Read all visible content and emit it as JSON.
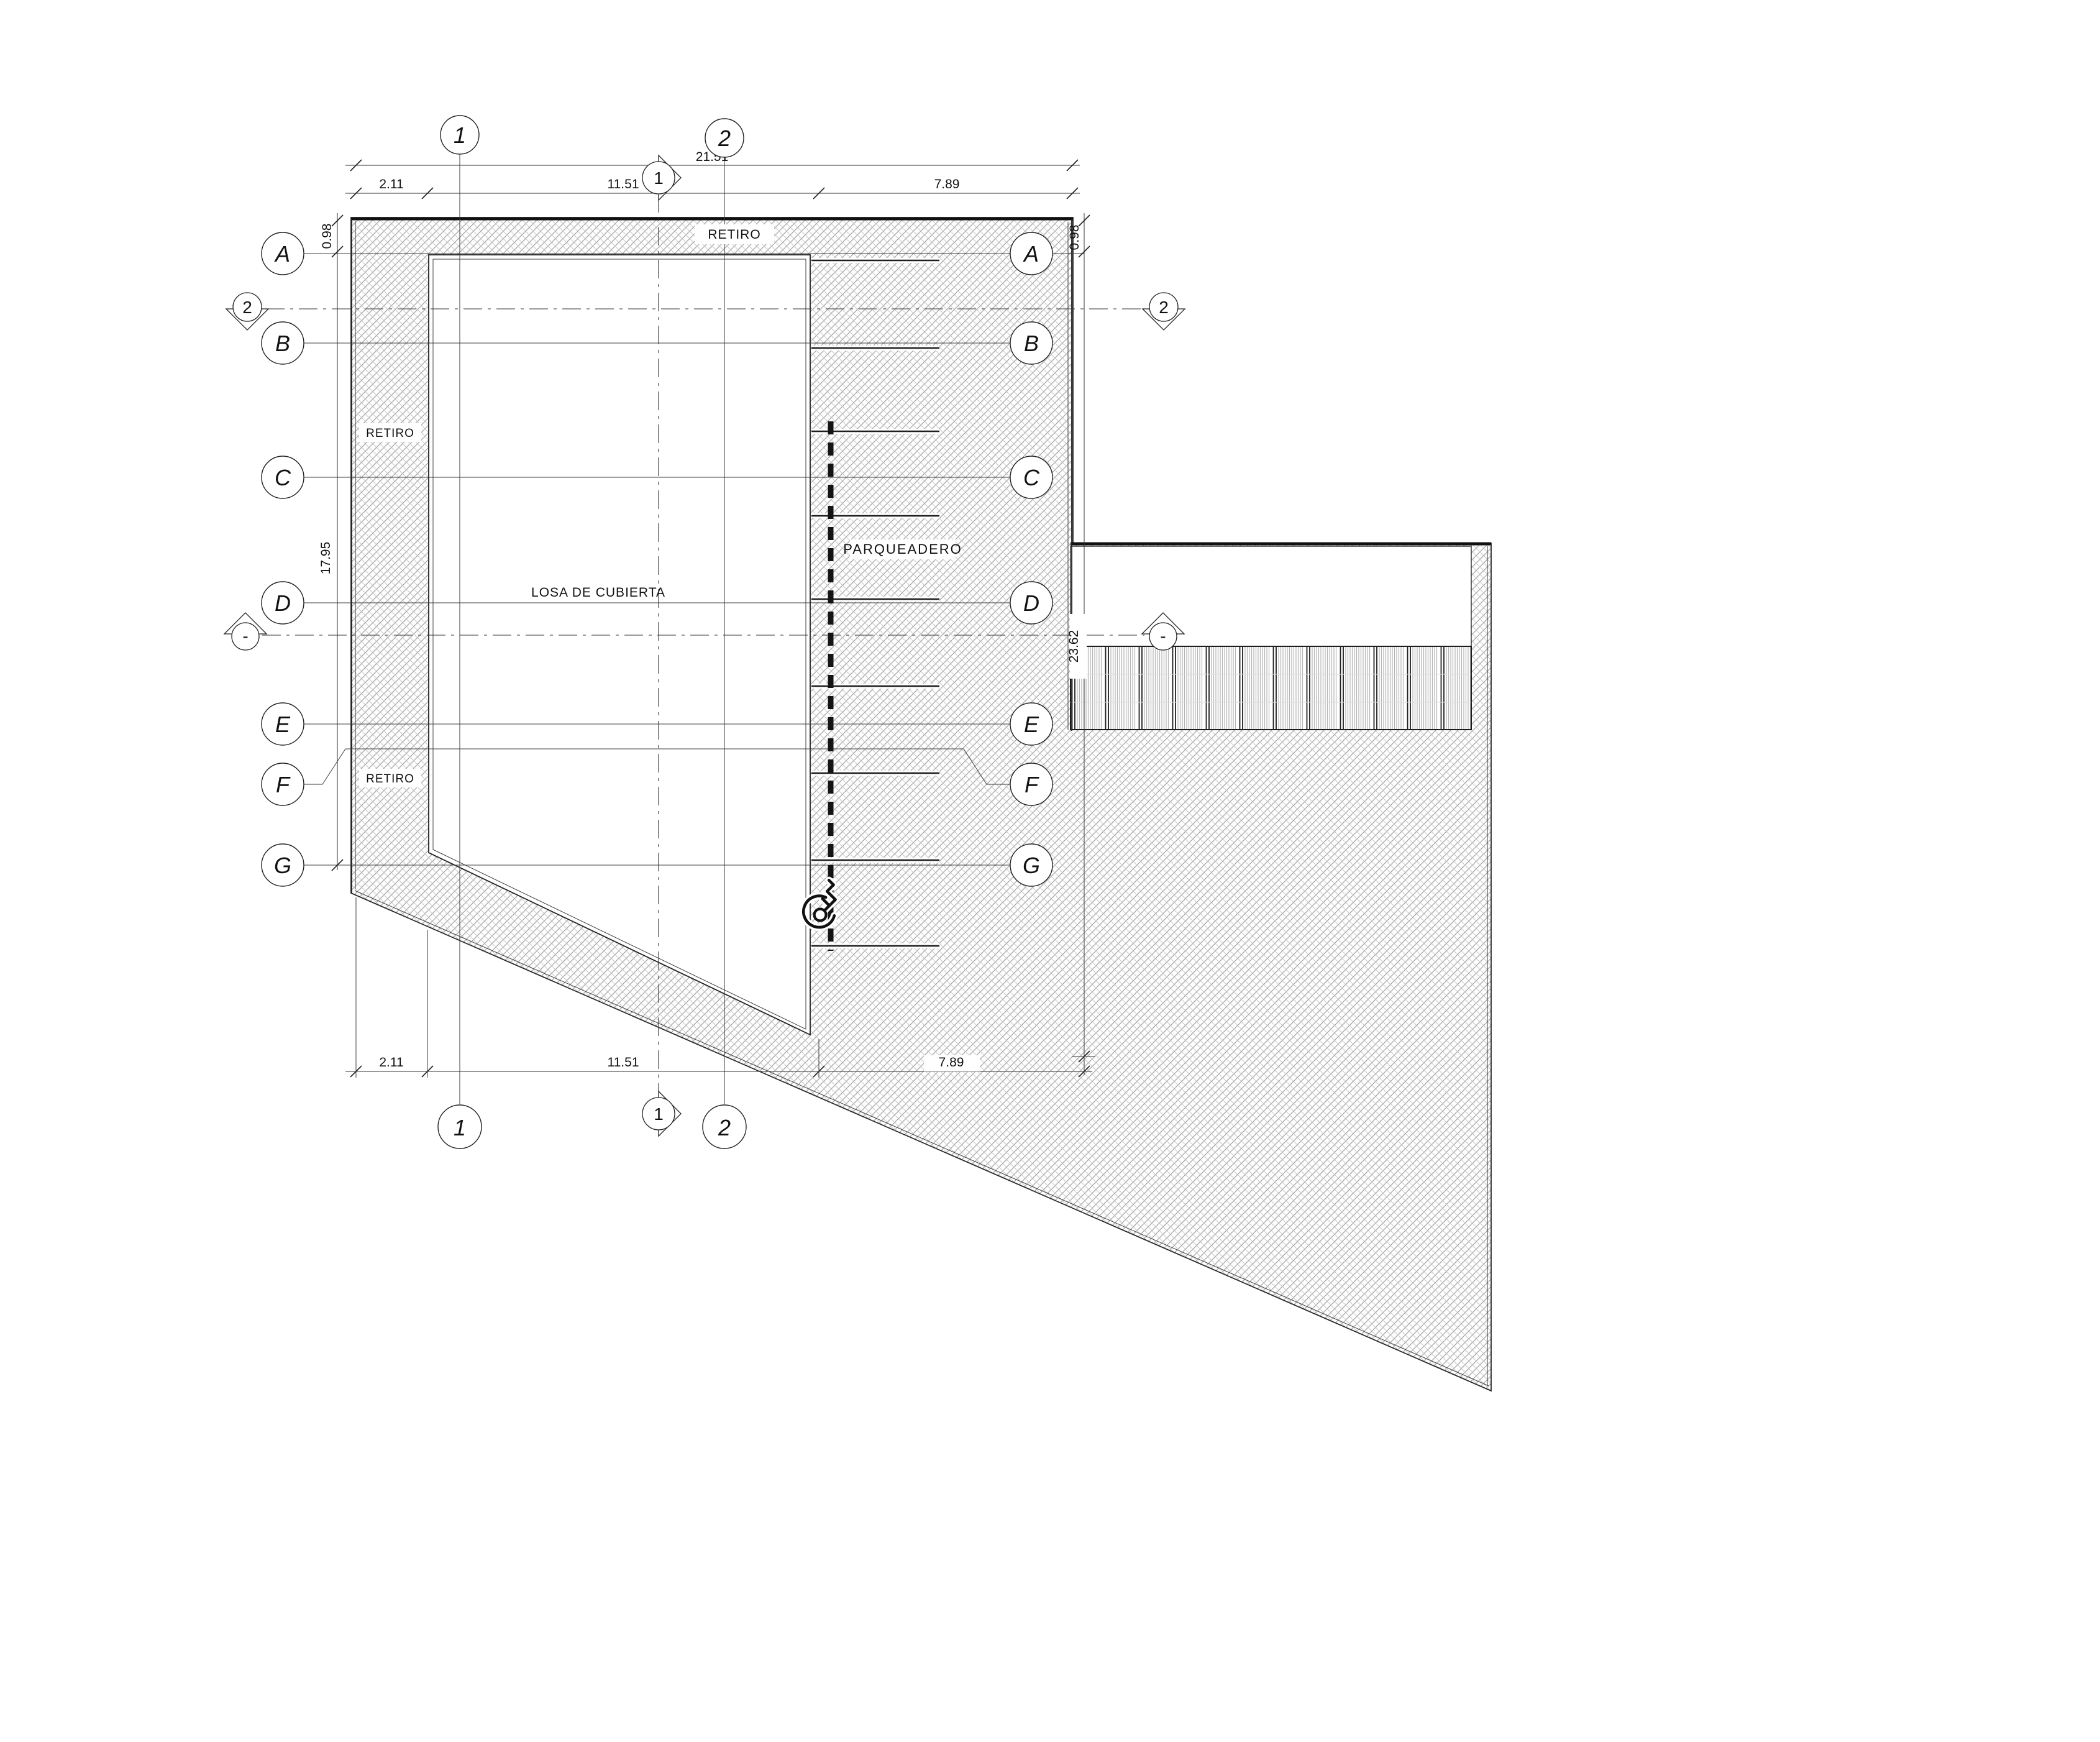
{
  "plan": {
    "labels": {
      "retiro_top": "RETIRO",
      "retiro_left_upper": "RETIRO",
      "retiro_left_lower": "RETIRO",
      "roof_slab": "LOSA DE CUBIERTA",
      "parking": "PARQUEADERO"
    },
    "grid": {
      "columns": [
        "1",
        "2"
      ],
      "rows": [
        "A",
        "B",
        "C",
        "D",
        "E",
        "F",
        "G"
      ]
    },
    "sections": {
      "section_one": "1",
      "section_two": "2",
      "section_dash": "-"
    },
    "dimensions": {
      "total_width": "21.51",
      "setback_width": "2.11",
      "slab_width": "11.51",
      "parking_width": "7.89",
      "setback_depth": "0.98",
      "grid_height": "17.95",
      "site_height": "23.62"
    }
  }
}
